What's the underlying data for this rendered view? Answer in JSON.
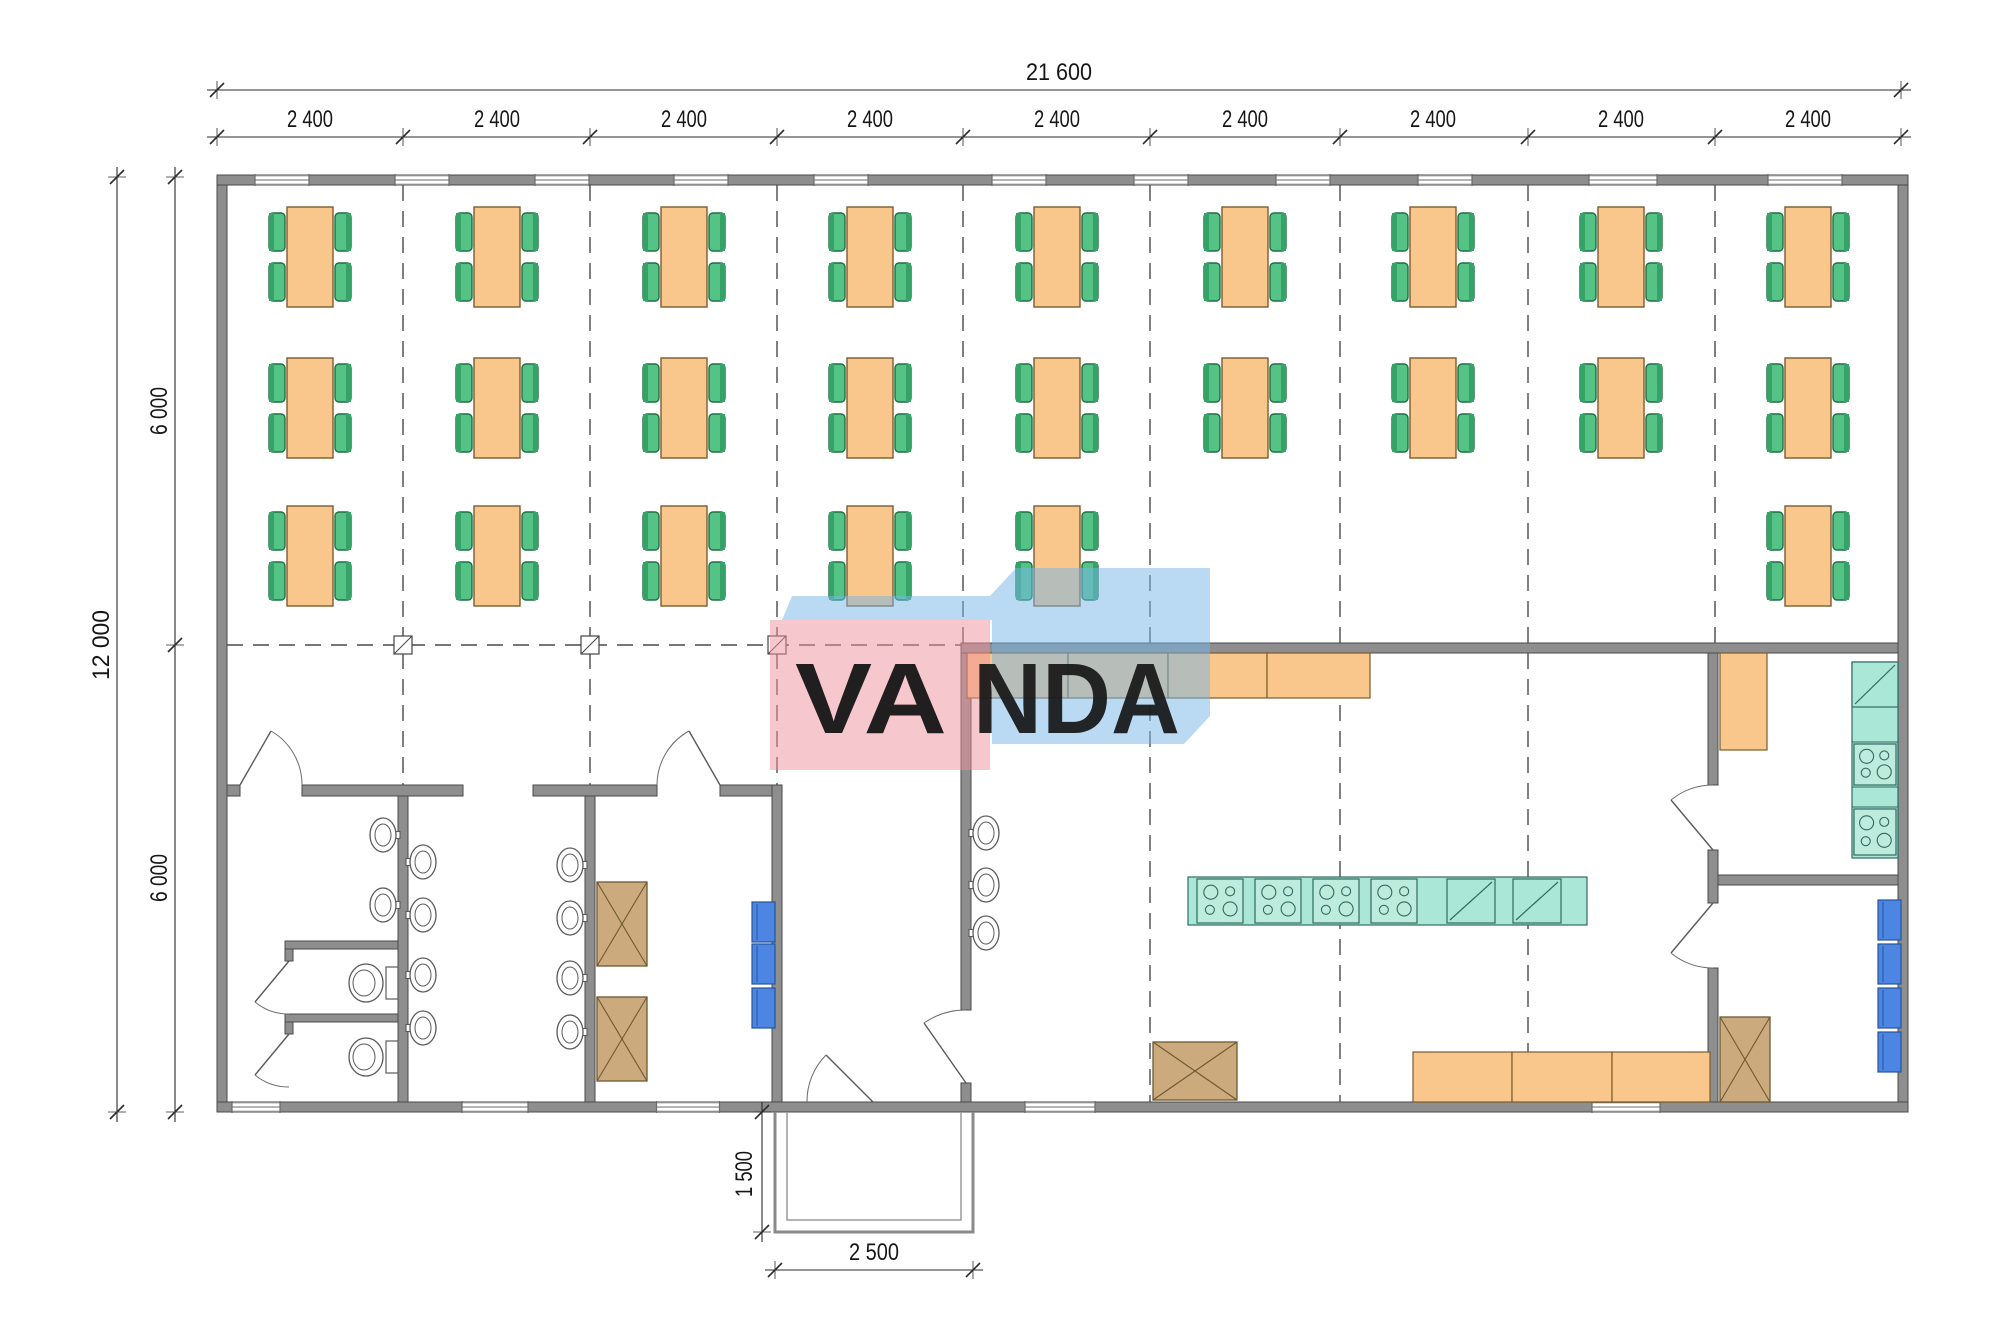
{
  "watermark": {
    "text": "VANDA",
    "front_letters": "VA",
    "back_letters": "NDA",
    "pink_color": "rgba(239,144,158,0.5)",
    "blue_color": "rgba(118,182,233,0.5)",
    "letter_color": "#ffffff"
  },
  "dimensions": {
    "total_width_label": "21 600",
    "bay_label": "2 400",
    "bay_count": 9,
    "total_height_label": "12 000",
    "half_height_labels": [
      "6 000",
      "6 000"
    ],
    "porch_depth_label": "1 500",
    "porch_width_label": "2 500"
  },
  "colors": {
    "wall": "#8e8e8e",
    "wall_edge": "#4a4a4a",
    "table_orange": "#f9c78b",
    "table_edge": "#7a5c2e",
    "chair_green": "#55c286",
    "chair_edge": "#1d6f42",
    "chair_back": "#35a368",
    "teal_unit": "#abe7d6",
    "teal_edge": "#2f6b60",
    "blue_unit": "#4d86e2",
    "blue_edge": "#24549e",
    "brown_cab": "#cbab7e",
    "brown_edge": "#6e5832",
    "fixture_line": "#5a5a5a",
    "grid_line": "#4a4a4a",
    "dim_line": "#2b2b2b"
  },
  "plan": {
    "canvas": {
      "w": 2000,
      "h": 1338
    },
    "walls": [
      [
        217,
        175,
        1691,
        10
      ],
      [
        217,
        1102,
        1691,
        10
      ],
      [
        217,
        185,
        10,
        917
      ],
      [
        1898,
        185,
        10,
        917
      ],
      [
        961,
        643,
        937,
        10
      ],
      [
        227,
        785,
        13,
        11
      ],
      [
        302,
        785,
        161,
        11
      ],
      [
        533,
        785,
        124,
        11
      ],
      [
        720,
        785,
        62,
        11
      ],
      [
        398,
        796,
        10,
        306
      ],
      [
        585,
        796,
        10,
        306
      ],
      [
        772,
        785,
        10,
        317
      ],
      [
        961,
        653,
        10,
        357
      ],
      [
        961,
        1083,
        10,
        19
      ],
      [
        1708,
        653,
        10,
        132
      ],
      [
        1708,
        850,
        10,
        53
      ],
      [
        1708,
        968,
        10,
        134
      ],
      [
        1718,
        875,
        180,
        10
      ],
      [
        285,
        941,
        113,
        8
      ],
      [
        285,
        1014,
        113,
        8
      ],
      [
        285,
        949,
        8,
        12
      ],
      [
        285,
        1022,
        8,
        12
      ]
    ],
    "windows_top": [
      {
        "cx": 282,
        "w": 54
      },
      {
        "cx": 422,
        "w": 54
      },
      {
        "cx": 562,
        "w": 54
      },
      {
        "cx": 701,
        "w": 54
      },
      {
        "cx": 841,
        "w": 54
      },
      {
        "cx": 1019,
        "w": 54
      },
      {
        "cx": 1161,
        "w": 54
      },
      {
        "cx": 1303,
        "w": 54
      },
      {
        "cx": 1445,
        "w": 54
      },
      {
        "cx": 1623,
        "w": 68
      },
      {
        "cx": 1805,
        "w": 74
      }
    ],
    "windows_bottom": [
      {
        "cx": 256,
        "w": 48
      },
      {
        "cx": 495,
        "w": 66
      },
      {
        "cx": 688,
        "w": 63
      },
      {
        "cx": 1060,
        "w": 70
      },
      {
        "cx": 1626,
        "w": 68
      }
    ],
    "grid": {
      "xs": [
        217,
        403,
        590,
        777,
        963,
        1150,
        1340,
        1528,
        1715,
        1901
      ],
      "vlines": [
        {
          "x": 403,
          "y1": 185,
          "y2": 785
        },
        {
          "x": 590,
          "y1": 185,
          "y2": 785
        },
        {
          "x": 777,
          "y1": 185,
          "y2": 785
        },
        {
          "x": 963,
          "y1": 185,
          "y2": 643
        },
        {
          "x": 1715,
          "y1": 185,
          "y2": 643
        },
        {
          "x": 1150,
          "y1": 185,
          "y2": 643
        },
        {
          "x": 1150,
          "y1": 653,
          "y2": 1102
        },
        {
          "x": 1340,
          "y1": 185,
          "y2": 643
        },
        {
          "x": 1340,
          "y1": 653,
          "y2": 1102
        },
        {
          "x": 1528,
          "y1": 185,
          "y2": 643
        },
        {
          "x": 1528,
          "y1": 653,
          "y2": 1102
        }
      ],
      "hline": {
        "y": 645,
        "x1": 227,
        "x2": 961
      },
      "columns": [
        403,
        590,
        777
      ]
    },
    "tables": {
      "bay_centers_x": [
        310,
        497,
        684,
        870,
        1057,
        1245,
        1433,
        1621,
        1808
      ],
      "rows": [
        {
          "y": 207,
          "bays": [
            0,
            1,
            2,
            3,
            4,
            5,
            6,
            7,
            8
          ]
        },
        {
          "y": 358,
          "bays": [
            0,
            1,
            2,
            3,
            4,
            5,
            6,
            7,
            8
          ]
        },
        {
          "y": 506,
          "bays": [
            0,
            1,
            2,
            3,
            4,
            8
          ]
        }
      ]
    },
    "sinks": [
      {
        "x": 383,
        "y": 835,
        "side": "e"
      },
      {
        "x": 383,
        "y": 905,
        "side": "e"
      },
      {
        "x": 423,
        "y": 862,
        "side": "w"
      },
      {
        "x": 423,
        "y": 915,
        "side": "w"
      },
      {
        "x": 423,
        "y": 975,
        "side": "w"
      },
      {
        "x": 423,
        "y": 1028,
        "side": "w"
      },
      {
        "x": 570,
        "y": 865,
        "side": "e"
      },
      {
        "x": 570,
        "y": 918,
        "side": "e"
      },
      {
        "x": 570,
        "y": 978,
        "side": "e"
      },
      {
        "x": 570,
        "y": 1032,
        "side": "e"
      },
      {
        "x": 986,
        "y": 833,
        "side": "w"
      },
      {
        "x": 986,
        "y": 885,
        "side": "w"
      },
      {
        "x": 986,
        "y": 933,
        "side": "w"
      }
    ],
    "toilets": [
      {
        "y": 983
      },
      {
        "y": 1057
      }
    ],
    "counters": [
      {
        "x": 967,
        "y": 653,
        "w": 101,
        "h": 45
      },
      {
        "x": 1068,
        "y": 653,
        "w": 100,
        "h": 45
      },
      {
        "x": 1168,
        "y": 653,
        "w": 99,
        "h": 45
      },
      {
        "x": 1267,
        "y": 653,
        "w": 103,
        "h": 45
      },
      {
        "x": 1413,
        "y": 1052,
        "w": 99,
        "h": 50
      },
      {
        "x": 1512,
        "y": 1052,
        "w": 100,
        "h": 50
      },
      {
        "x": 1612,
        "y": 1052,
        "w": 98,
        "h": 50
      },
      {
        "x": 1720,
        "y": 653,
        "w": 47,
        "h": 97
      }
    ],
    "island": {
      "x": 1188,
      "y": 877,
      "w": 399,
      "h": 48,
      "stoves": [
        1197,
        1255,
        1313,
        1371
      ],
      "cellW": 46,
      "cellH": 44,
      "diags": [
        1447,
        1513
      ],
      "diagW": 48
    },
    "right_strip": {
      "x": 1852,
      "y": 662,
      "w": 46,
      "h": 196,
      "dividers": [
        707,
        742,
        787,
        807
      ],
      "diag": {
        "y": 662,
        "h": 45
      },
      "stoves": [
        {
          "y": 742,
          "h": 45
        },
        {
          "y": 807,
          "h": 50
        }
      ]
    },
    "blue_units": [
      {
        "x": 752,
        "y": 902
      },
      {
        "x": 752,
        "y": 944
      },
      {
        "x": 752,
        "y": 988
      },
      {
        "x": 1878,
        "y": 900
      },
      {
        "x": 1878,
        "y": 944
      },
      {
        "x": 1878,
        "y": 988
      },
      {
        "x": 1878,
        "y": 1032
      }
    ],
    "x_cabinets": [
      {
        "x": 597,
        "y": 882,
        "w": 50,
        "h": 84
      },
      {
        "x": 597,
        "y": 997,
        "w": 50,
        "h": 84
      },
      {
        "x": 1153,
        "y": 1042,
        "w": 84,
        "h": 58
      },
      {
        "x": 1720,
        "y": 1017,
        "w": 50,
        "h": 85
      }
    ],
    "doors": [
      {
        "leaf": [
          240,
          785,
          271,
          731
        ],
        "arc": "M271,731 A62,62 0 0 1 302,785"
      },
      {
        "leaf": [
          720,
          785,
          689,
          731
        ],
        "arc": "M689,731 A62,62 0 0 0 657,785"
      },
      {
        "leaf": [
          966,
          1083,
          924,
          1023
        ],
        "arc": "M924,1023 A73,73 0 0 1 966,1010"
      },
      {
        "leaf": [
          873,
          1102,
          826,
          1055
        ],
        "arc": "M826,1055 A66,66 0 0 0 807,1102"
      },
      {
        "leaf": [
          1713,
          850,
          1671,
          800
        ],
        "arc": "M1671,800 A65,65 0 0 1 1713,785"
      },
      {
        "leaf": [
          1713,
          903,
          1671,
          953
        ],
        "arc": "M1671,953 A65,65 0 0 0 1713,968"
      },
      {
        "leaf": [
          289,
          961,
          255,
          1002
        ],
        "arc": "M255,1002 A53,53 0 0 0 289,1014"
      },
      {
        "leaf": [
          289,
          1034,
          255,
          1075
        ],
        "arc": "M255,1075 A53,53 0 0 0 289,1087"
      }
    ],
    "porch": {
      "outer": "M775,1112 L775,1232 L973,1232 L973,1112",
      "inner": "M787,1112 L787,1220 L961,1220 L961,1112"
    },
    "dim_lines": [
      {
        "type": "h",
        "y": 90,
        "x1": 217,
        "x2": 1901,
        "ticks": [
          217,
          1901
        ]
      },
      {
        "type": "h",
        "y": 137,
        "x1": 217,
        "x2": 1901,
        "ticks": [
          217,
          403,
          590,
          777,
          963,
          1150,
          1340,
          1528,
          1715,
          1901
        ]
      },
      {
        "type": "v",
        "x": 117,
        "y1": 177,
        "y2": 1112,
        "ticks": [
          177,
          1112
        ]
      },
      {
        "type": "v",
        "x": 175,
        "y1": 177,
        "y2": 1112,
        "ticks": [
          177,
          645,
          1112
        ]
      },
      {
        "type": "v",
        "x": 762,
        "y1": 1112,
        "y2": 1232,
        "ticks": [
          1112,
          1232
        ]
      },
      {
        "type": "h",
        "y": 1270,
        "x1": 775,
        "x2": 973,
        "ticks": [
          775,
          973
        ]
      }
    ],
    "bay_label_y": 127,
    "half_label_pos": [
      {
        "x": 167,
        "y": 411
      },
      {
        "x": 167,
        "y": 878
      }
    ],
    "watermark_geo": {
      "blue_path": "M782,620 L792,596 L990,596 L1016,568 L1210,568 L1210,716 L1184,744 L992,744 L992,620 Z",
      "pink_rect": [
        770,
        620,
        220,
        150
      ],
      "front_x": 795,
      "back_x": 973,
      "text_y": 733,
      "front_len": 152,
      "back_len": 207
    }
  }
}
